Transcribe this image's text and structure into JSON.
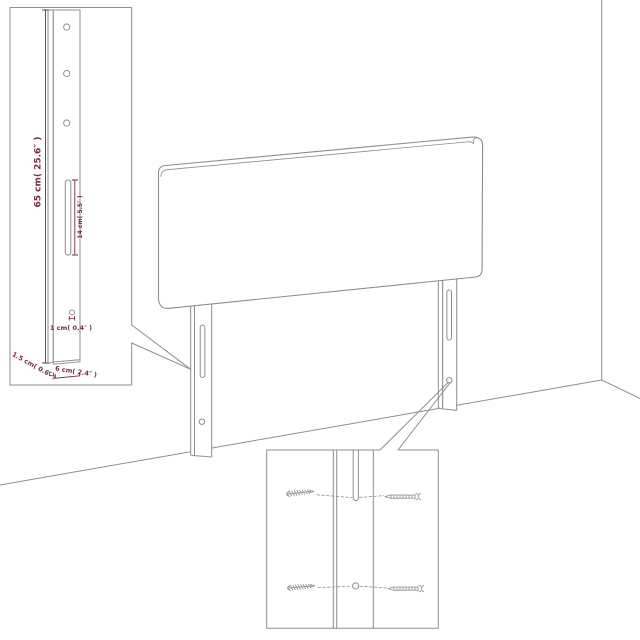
{
  "colors": {
    "background": "#ffffff",
    "line": "#8e8e8e",
    "dimension": "#752e44"
  },
  "dimensions": {
    "leg_height": "65 cm( 25.6″ )",
    "slot_length": "14 cm( 5.5″ )",
    "hole_diameter": "1 cm( 0.4″ )",
    "leg_depth": "1.5 cm( 0.6″ )",
    "leg_width": "6 cm( 2.4″ )"
  }
}
